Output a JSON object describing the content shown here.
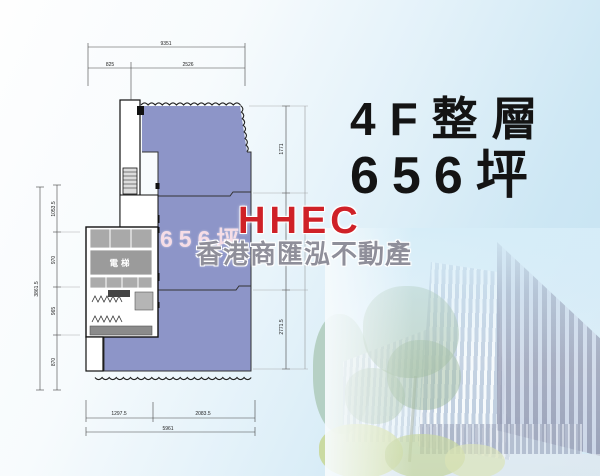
{
  "title": {
    "floor": "4F整層",
    "area": "656坪"
  },
  "brand": {
    "name": "HHEC",
    "company": "香港商匯泓不動產"
  },
  "plan": {
    "area_watermark": "656坪",
    "elevator_label": "電梯",
    "area_fill": "#8d95c8",
    "dims": {
      "top_total": "9351",
      "top_seg1": "825",
      "top_seg2": "2526",
      "left_total": "3861.5",
      "left_seg1": "1053.5",
      "left_seg2": "970",
      "left_seg3": "965",
      "left_seg4": "870",
      "right_seg1": "1771",
      "right_seg2": "2771.5",
      "bottom_seg1": "1297.5",
      "bottom_seg2": "2083.5",
      "bottom_total": "5961"
    }
  },
  "colors": {
    "background_sky": "#c3e1f1",
    "title_text": "#141414",
    "brand_red": "#cf2127",
    "company_gray": "#8f8f9a",
    "plan_fill": "#8d95c8",
    "building_dark": "#5d6589"
  }
}
